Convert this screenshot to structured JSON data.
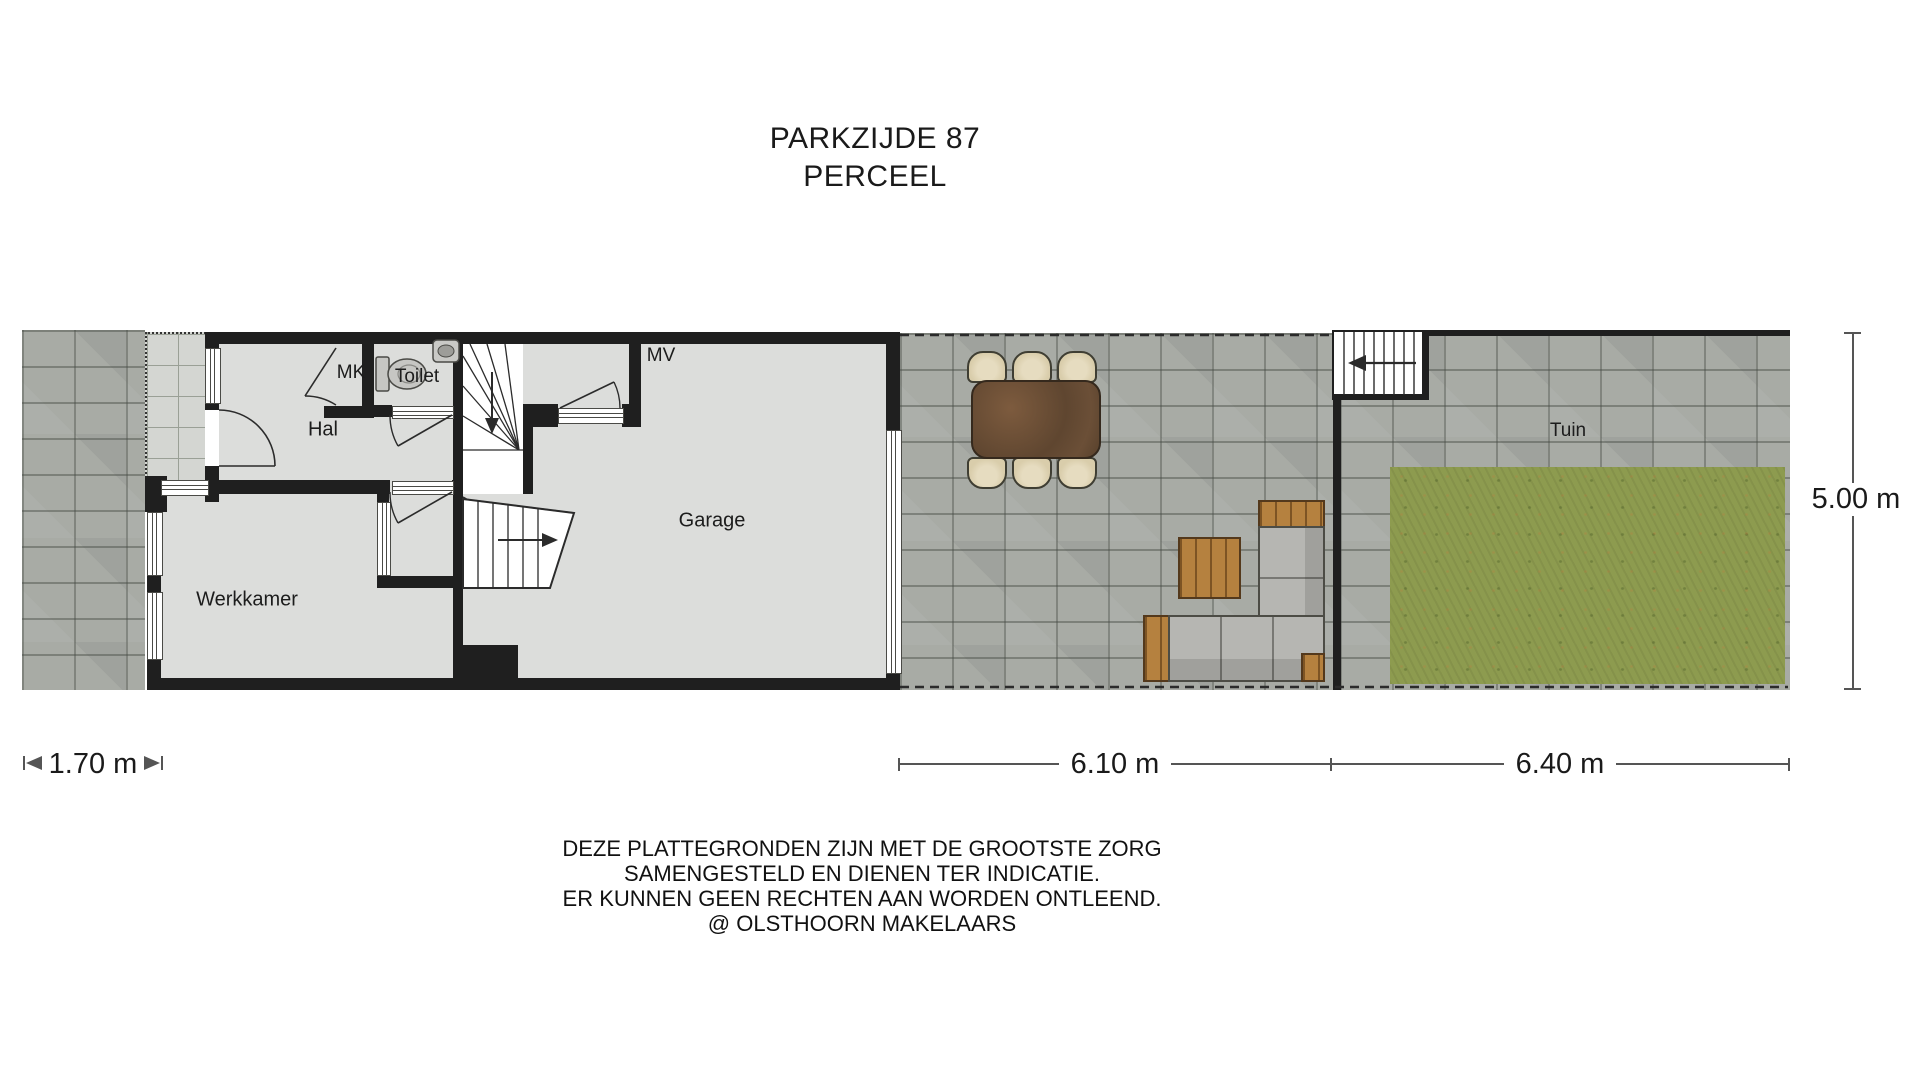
{
  "title": {
    "line1": "PARKZIJDE 87",
    "line2": "PERCEEL"
  },
  "rooms": {
    "hal": "Hal",
    "mk": "MK",
    "toilet": "Toilet",
    "mv": "MV",
    "garage": "Garage",
    "werkkamer": "Werkkamer",
    "tuin": "Tuin"
  },
  "dimensions": {
    "front_width": "1.70 m",
    "terrace_width": "6.10 m",
    "garden_width": "6.40 m",
    "depth": "5.00 m"
  },
  "disclaimer": {
    "line1": "DEZE PLATTEGRONDEN ZIJN MET DE GROOTSTE ZORG",
    "line2": "SAMENGESTELD EN DIENEN TER INDICATIE.",
    "line3": "ER KUNNEN GEEN RECHTEN AAN WORDEN ONTLEEND.",
    "line4": "@ OLSTHOORN MAKELAARS"
  },
  "colors": {
    "wall": "#1f1f1f",
    "floor": "#dcdddb",
    "paver": "#a8aba5",
    "tile": "#d4d6d2",
    "grass": "#8d9b4f",
    "wood": "#b5813f",
    "chair": "#d9cdab",
    "sofa": "#b6b6b2",
    "line": "#2b2b2b"
  }
}
